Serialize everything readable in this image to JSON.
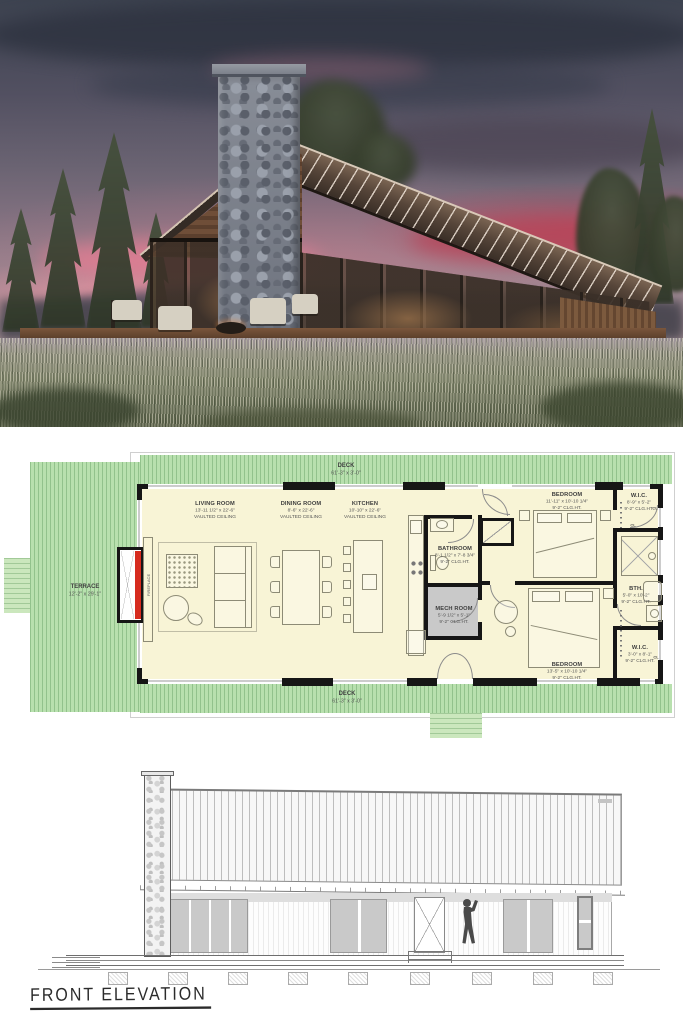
{
  "floor_plan": {
    "deck_top": {
      "name": "DECK",
      "dims": "61'-3\" x 3'-0\""
    },
    "deck_bottom": {
      "name": "DECK",
      "dims": "61'-3\" x 3'-0\""
    },
    "terrace": {
      "name": "TERRACE",
      "dims": "12'-2\" x 29'-1\""
    },
    "fireplace": {
      "name": "FIREPLACE"
    },
    "living_room": {
      "name": "LIVING ROOM",
      "dims": "13'-11 1/2\" x 22'-6\"",
      "note": "VAULTED CEILING"
    },
    "dining_room": {
      "name": "DINING ROOM",
      "dims": "8'-6\" x 22'-6\"",
      "note": "VAULTED CEILING"
    },
    "kitchen": {
      "name": "KITCHEN",
      "dims": "10'-10\" x 22'-6\"",
      "note": "VAULTED CEILING"
    },
    "bathroom": {
      "name": "BATHROOM",
      "dims": "8'-1 1/2\" x 7'-8 3/4\"",
      "note": "9'-2\" CLG.HT."
    },
    "mech_room": {
      "name": "MECH ROOM",
      "dims": "5'-9 1/2\" x 5'-1\"",
      "note": "9'-2\" CLG.HT."
    },
    "bedroom_1": {
      "name": "BEDROOM",
      "dims": "11'-11\" x 10'-10 1/4\"",
      "note": "9'-2\" CLG.HT."
    },
    "wic_1": {
      "name": "W.I.C.",
      "dims": "8'-9\" x 5'-2\"",
      "note": "9'-2\" CLG.HT."
    },
    "bath_2": {
      "name": "BTH.",
      "dims": "5'-0\" x 10'-2\"",
      "note": "9'-2\" CLG.HT."
    },
    "wic_2": {
      "name": "W.I.C.",
      "dims": "3'-0\" x 8'-1\"",
      "note": "9'-2\" CLG.HT."
    },
    "bedroom_2": {
      "name": "BEDROOM",
      "dims": "13'-5\" x 10'-10 1/4\"",
      "note": "9'-2\" CLG.HT."
    },
    "closet_label": "CL"
  },
  "elevation": {
    "caption": "FRONT ELEVATION"
  },
  "colors": {
    "deck_green": "#b8e0ae",
    "stoop_green": "#cbe7bd",
    "floor_yellow": "#f8f4d6",
    "wall_black": "#161616",
    "fireplace_red": "#d62b1e",
    "mech_gray": "#c9c9c9",
    "sunset_pink": "#e07990",
    "roof_bronze": "#5d4a3c"
  }
}
